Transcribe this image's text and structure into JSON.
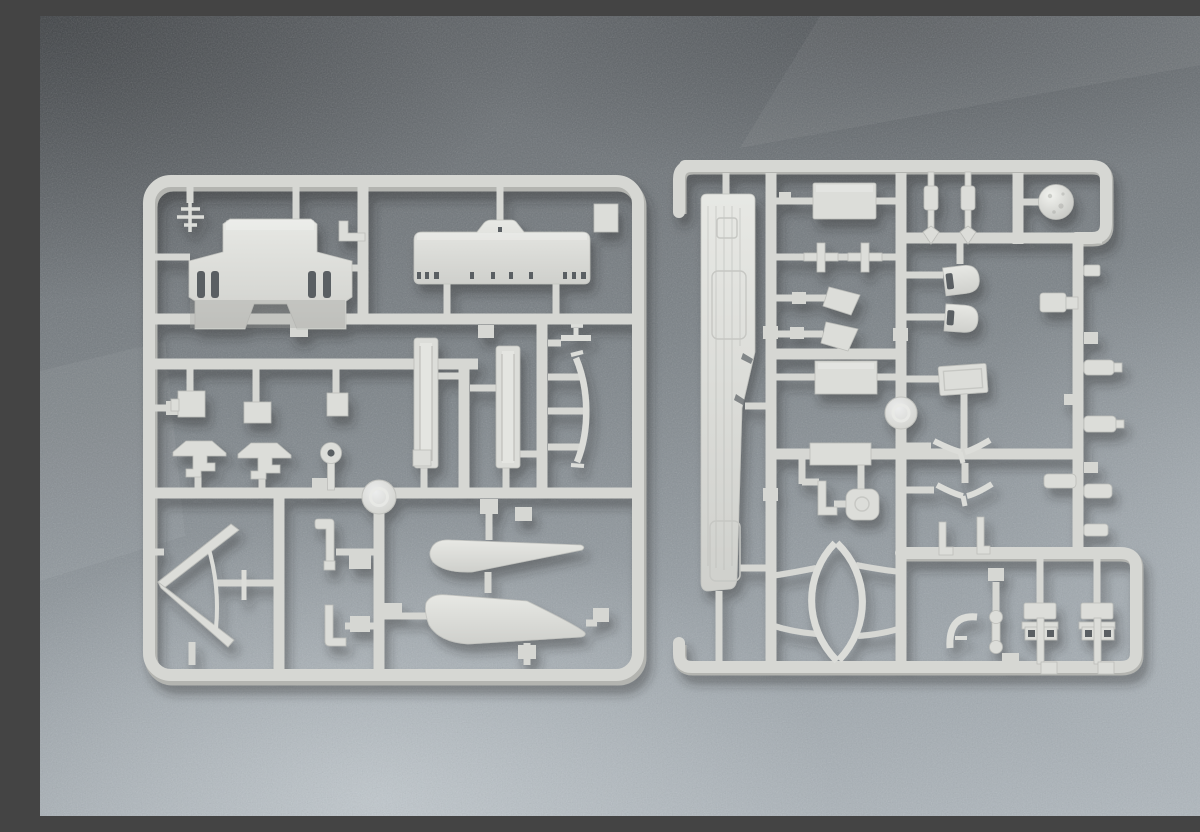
{
  "scene": {
    "type": "photograph",
    "description": "Two light-grey injection-moulded plastic model-kit sprues (part trees) for a warship model kit, lying side by side on a blue-grey speckled brushed-metal surface",
    "colors": {
      "background_top": "#5f6367",
      "background_mid": "#7b8287",
      "background_bottom": "#b0b8be",
      "sprue_plastic": "#d6d7d3",
      "sprue_plastic_light": "#dcddd9",
      "sprue_plastic_dark": "#b3b4b0",
      "hole_shadow": "#5a5f63",
      "cast_shadow": "#23282c"
    }
  },
  "sprues": [
    {
      "id": "left-sprue",
      "label": "Left sprue",
      "parts": [
        "antenna mast",
        "bridge superstructure",
        "deck platform",
        "corner tab",
        "mounting bracket",
        "fitting box A",
        "fitting box B",
        "fitting box C",
        "anvil bracket 1",
        "anvil bracket 2",
        "ring pin",
        "rail section 1",
        "rail section 2",
        "curved rib",
        "T-peg",
        "chevron bow brace",
        "J-hook 1",
        "J-hook 2",
        "blade fairing 1",
        "blade fairing 2",
        "sprue gate"
      ]
    },
    {
      "id": "right-sprue",
      "label": "Right sprue",
      "parts": [
        "main deck",
        "equipment box 1",
        "cross fitting 1",
        "cross fitting 2",
        "funnel cone 1",
        "funnel cone 2",
        "equipment box 2",
        "equipment box 3",
        "rounded knob",
        "L-pin 1",
        "hull outline ring",
        "mast barrel 1",
        "mast barrel 2",
        "ship's boat 1",
        "ship's boat 2",
        "base plate",
        "radar dome",
        "V-davit 1",
        "V-davit 2",
        "L-pin 2",
        "L-pin 3",
        "curved hook",
        "dumbbell pin",
        "gun mount 1",
        "gun mount 2",
        "barrel peg set",
        "sprue gate"
      ]
    }
  ]
}
